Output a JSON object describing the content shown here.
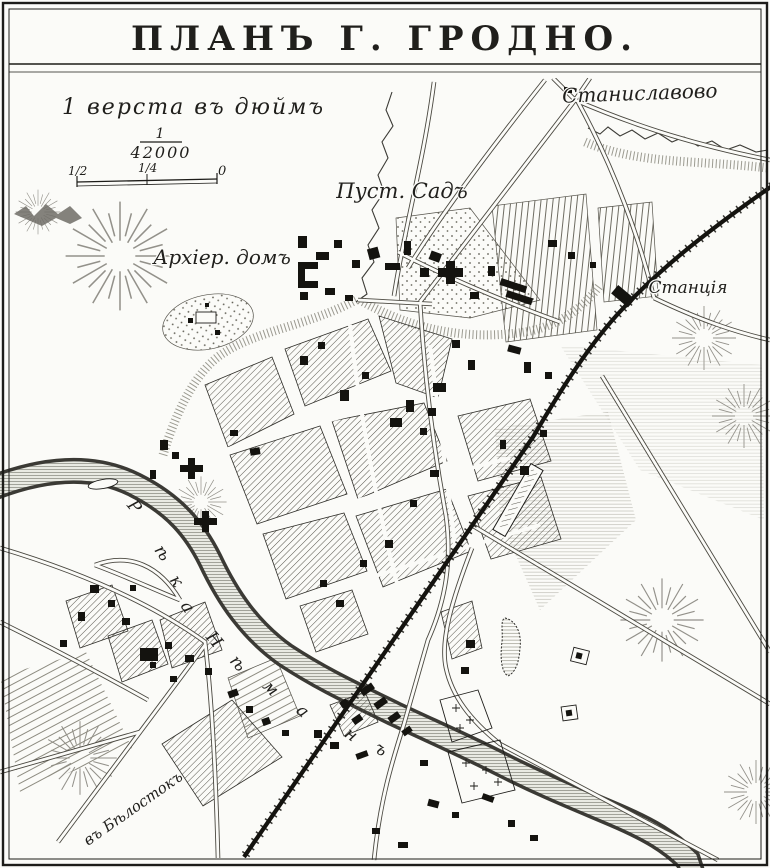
{
  "title": "ПЛАНЪ Г. ГРОДНО.",
  "scale": {
    "caption": "1 верста въ дюймъ",
    "fraction_numerator": "1",
    "fraction_denominator": "42000",
    "tick_half": "1/2",
    "tick_quarter": "1/4",
    "tick_zero": "0"
  },
  "labels": {
    "stanislavovo": "Станиславово",
    "pust_sad": "Пуст. Садъ",
    "archier_dom": "Архіер. домъ",
    "stantsia": "Станція",
    "belostok": "въ Бѣлостокъ"
  },
  "river": {
    "name": "Рѣка Нѣманъ",
    "letters": [
      "Р",
      "ѣ",
      "к",
      "а",
      "Н",
      "ѣ",
      "м",
      "а",
      "н",
      "ъ"
    ]
  },
  "colors": {
    "ink": "#1d1c19",
    "paper": "#fbfbf8"
  }
}
